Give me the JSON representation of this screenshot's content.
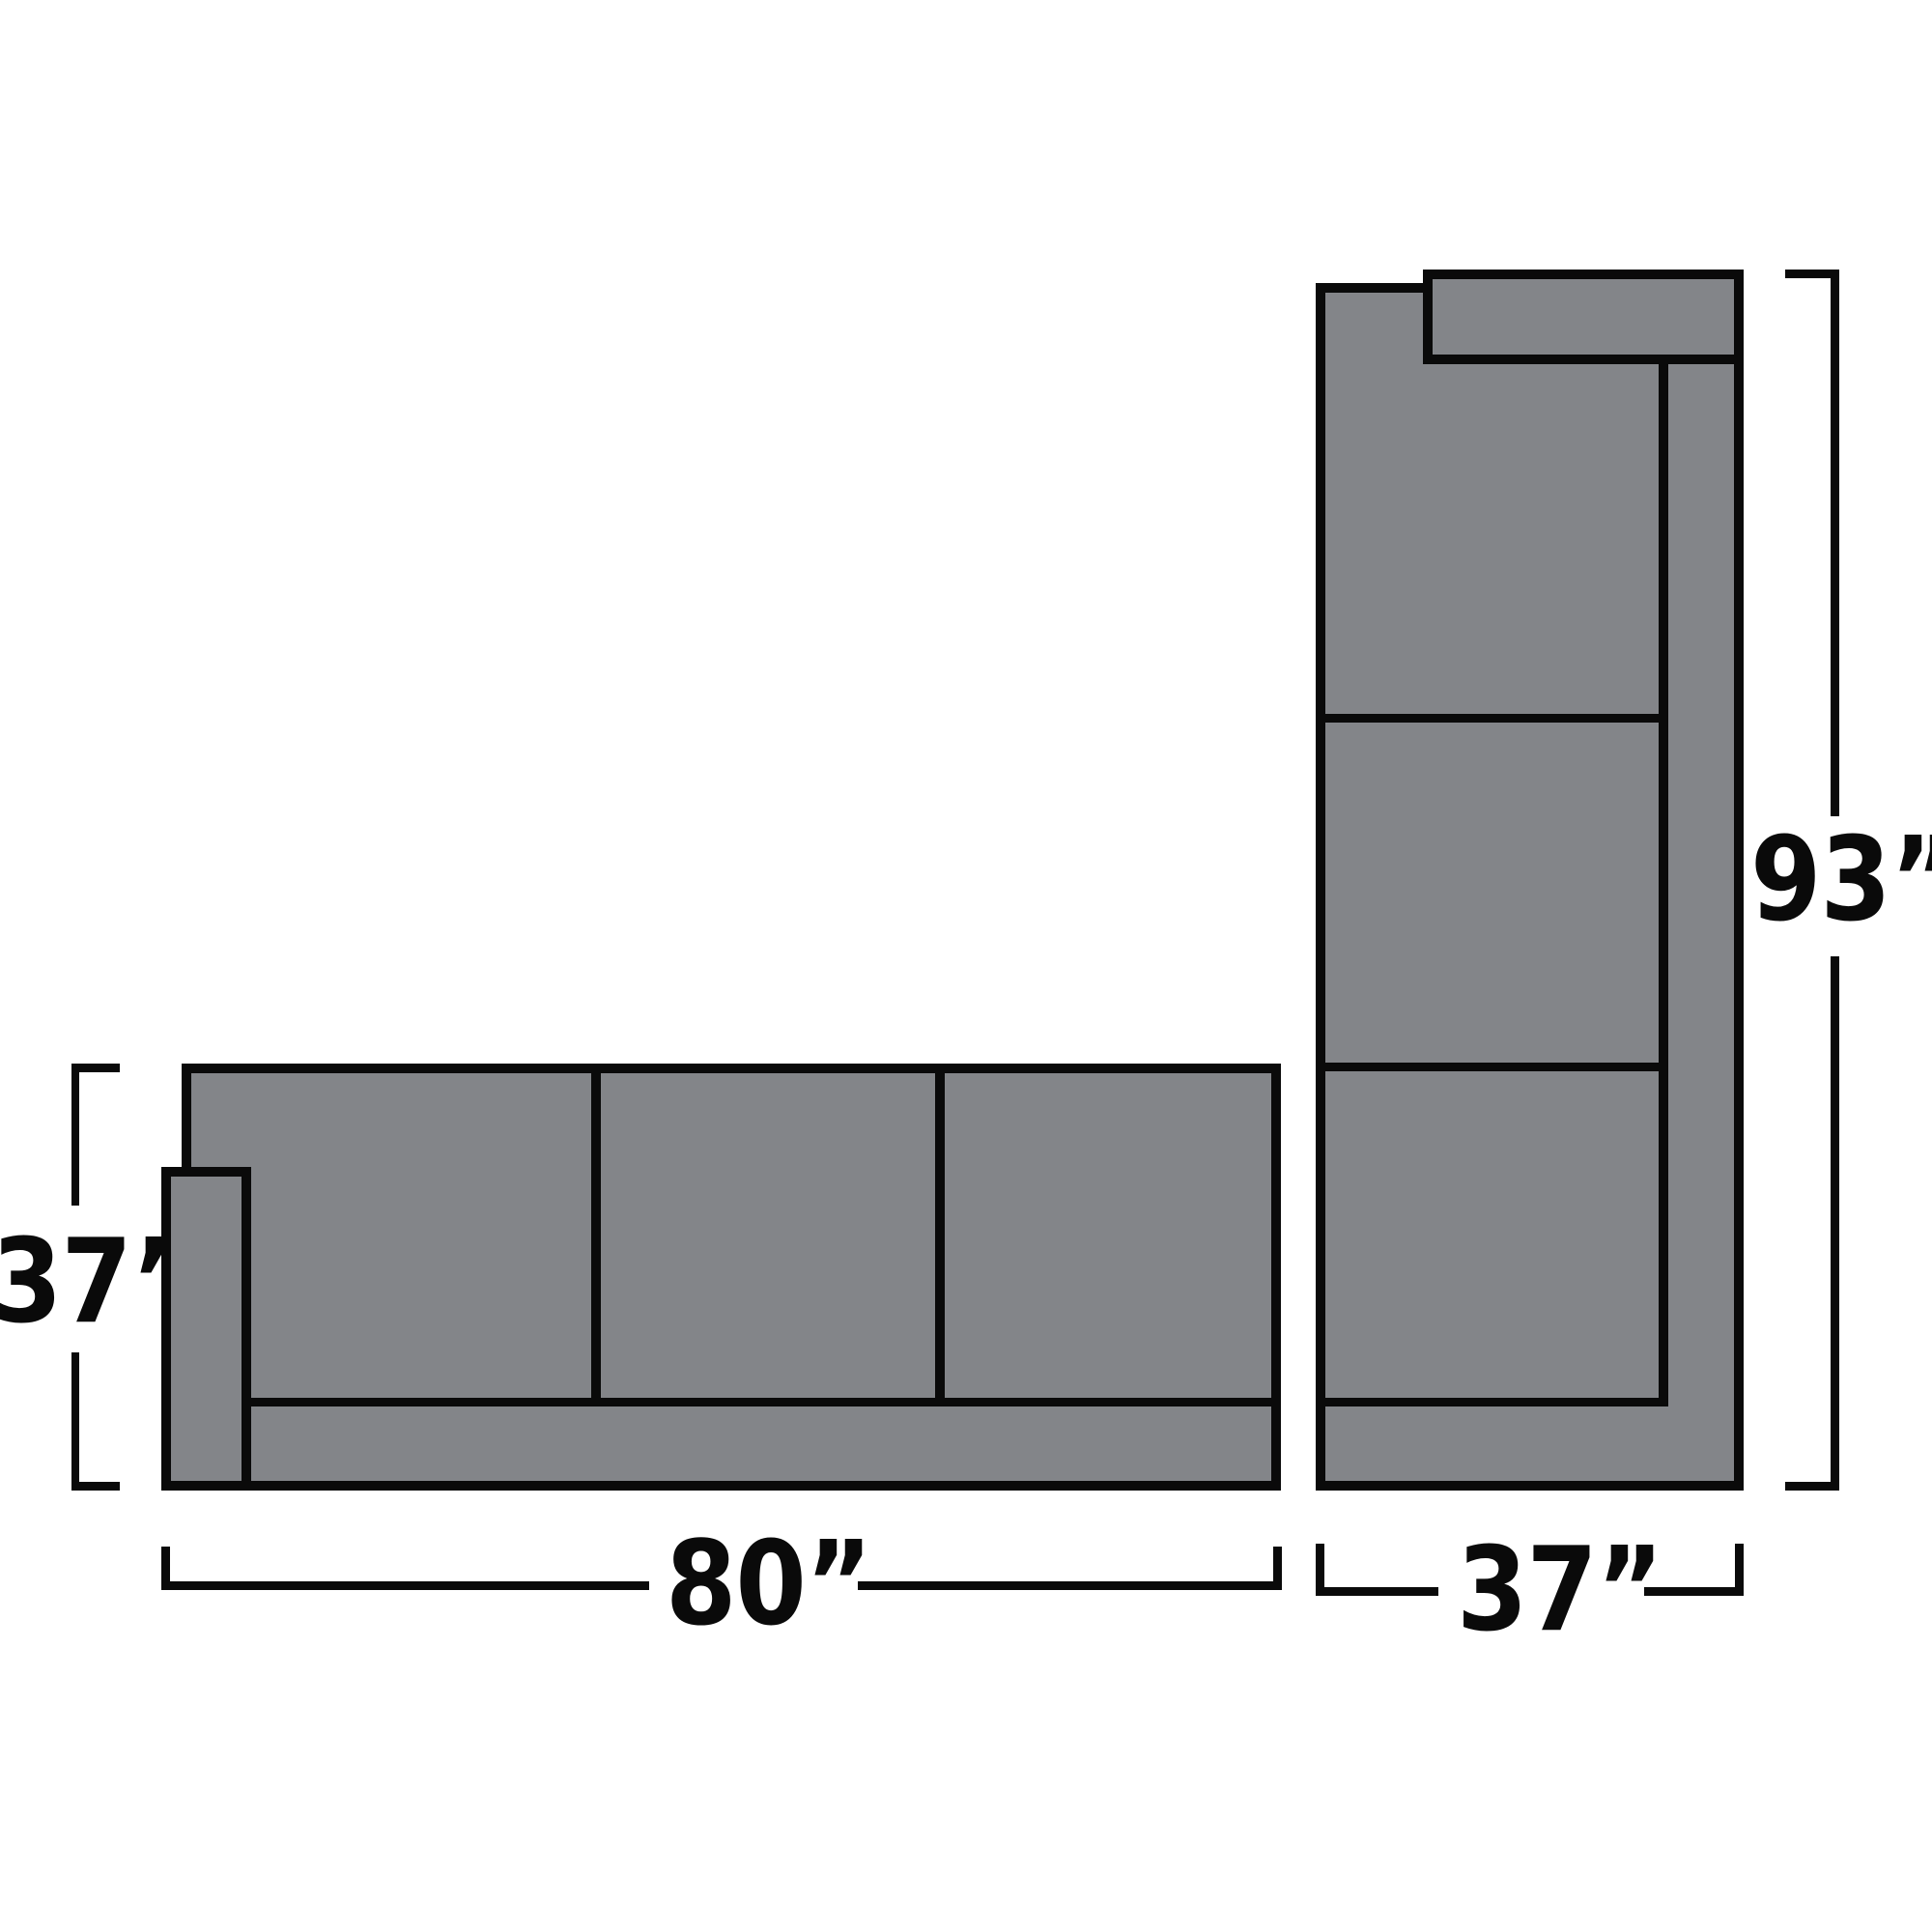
{
  "diagram": {
    "type": "sectional-sofa-dimension-diagram",
    "unit": "inches",
    "colors": {
      "background": "#ffffff",
      "sofa_fill": "#838589",
      "outline": "#0a0a0a"
    },
    "pieces": [
      {
        "id": "sofa-horizontal",
        "orientation": "horizontal",
        "cushion_count": 3,
        "width_label": "80”",
        "depth_label": "37”",
        "arm_side": "left"
      },
      {
        "id": "sofa-vertical",
        "orientation": "vertical",
        "cushion_count": 3,
        "length_label": "93”",
        "width_label": "37”",
        "arm_side": "top"
      }
    ],
    "labels": {
      "depth_left": "37”",
      "width_bottom": "80”",
      "length_right": "93”",
      "width_bottom_right": "37”"
    }
  }
}
